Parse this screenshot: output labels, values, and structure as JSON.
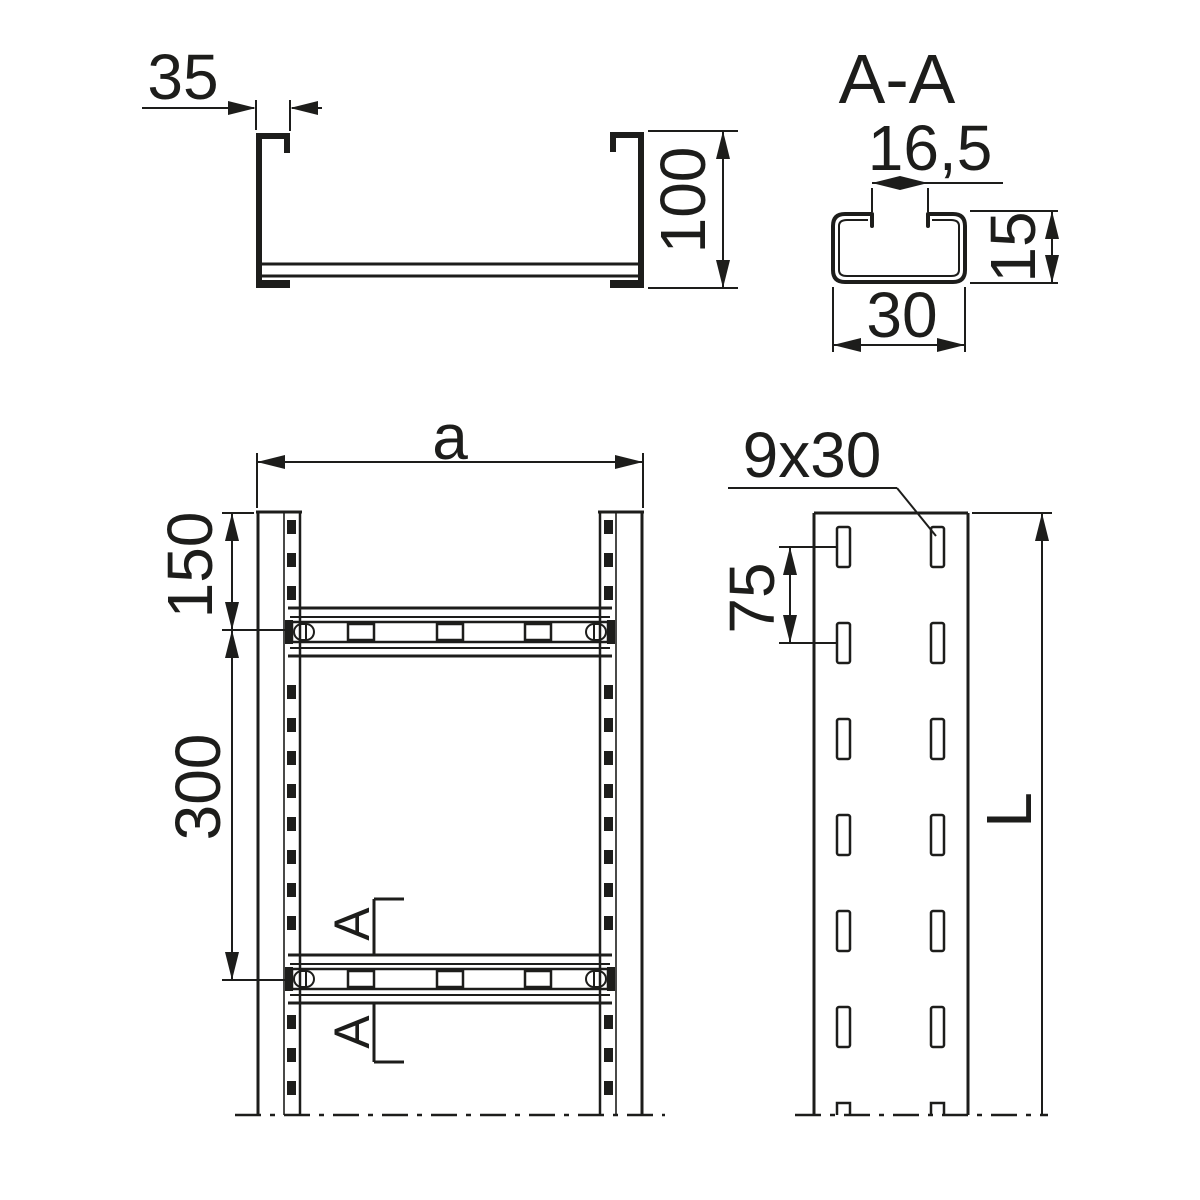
{
  "colors": {
    "line": "#1d1d1b",
    "background": "#ffffff"
  },
  "views": {
    "cross_section": {
      "lip_width": "35",
      "height": "100"
    },
    "section_aa": {
      "title": "A-A",
      "opening_width": "16,5",
      "profile_height": "15",
      "profile_width": "30"
    },
    "front": {
      "width": "a",
      "end_to_rung": "150",
      "rung_spacing": "300",
      "section_mark": "A"
    },
    "side": {
      "slot_size": "9x30",
      "slot_spacing": "75",
      "length": "L"
    }
  }
}
